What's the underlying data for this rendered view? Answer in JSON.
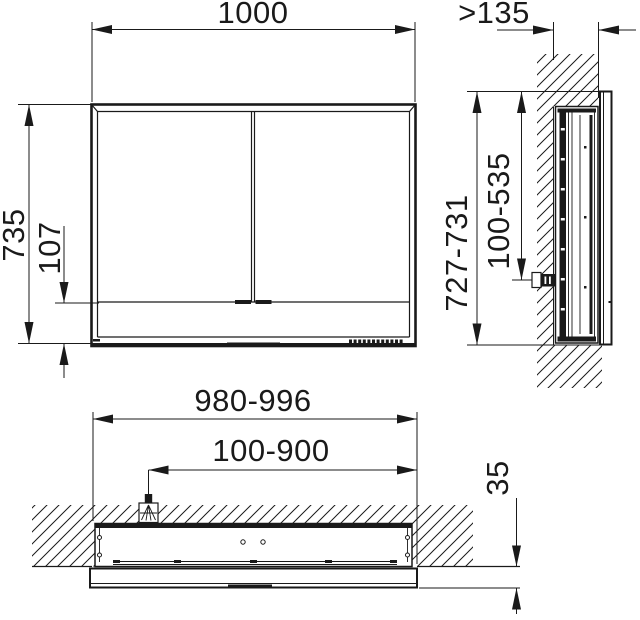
{
  "drawing": {
    "title": "mirror-cabinet installation drawing",
    "colors": {
      "line": "#1a1a1a",
      "background": "#ffffff"
    },
    "labels": {
      "front_width": "1000",
      "front_height": "735",
      "front_bottom_section": "107",
      "niche_depth": ">135",
      "side_height_range": "727-731",
      "outlet_height_range": "100-535",
      "niche_width_range": "980-996",
      "cable_position_range": "100-900",
      "protrusion_depth": "35"
    }
  }
}
